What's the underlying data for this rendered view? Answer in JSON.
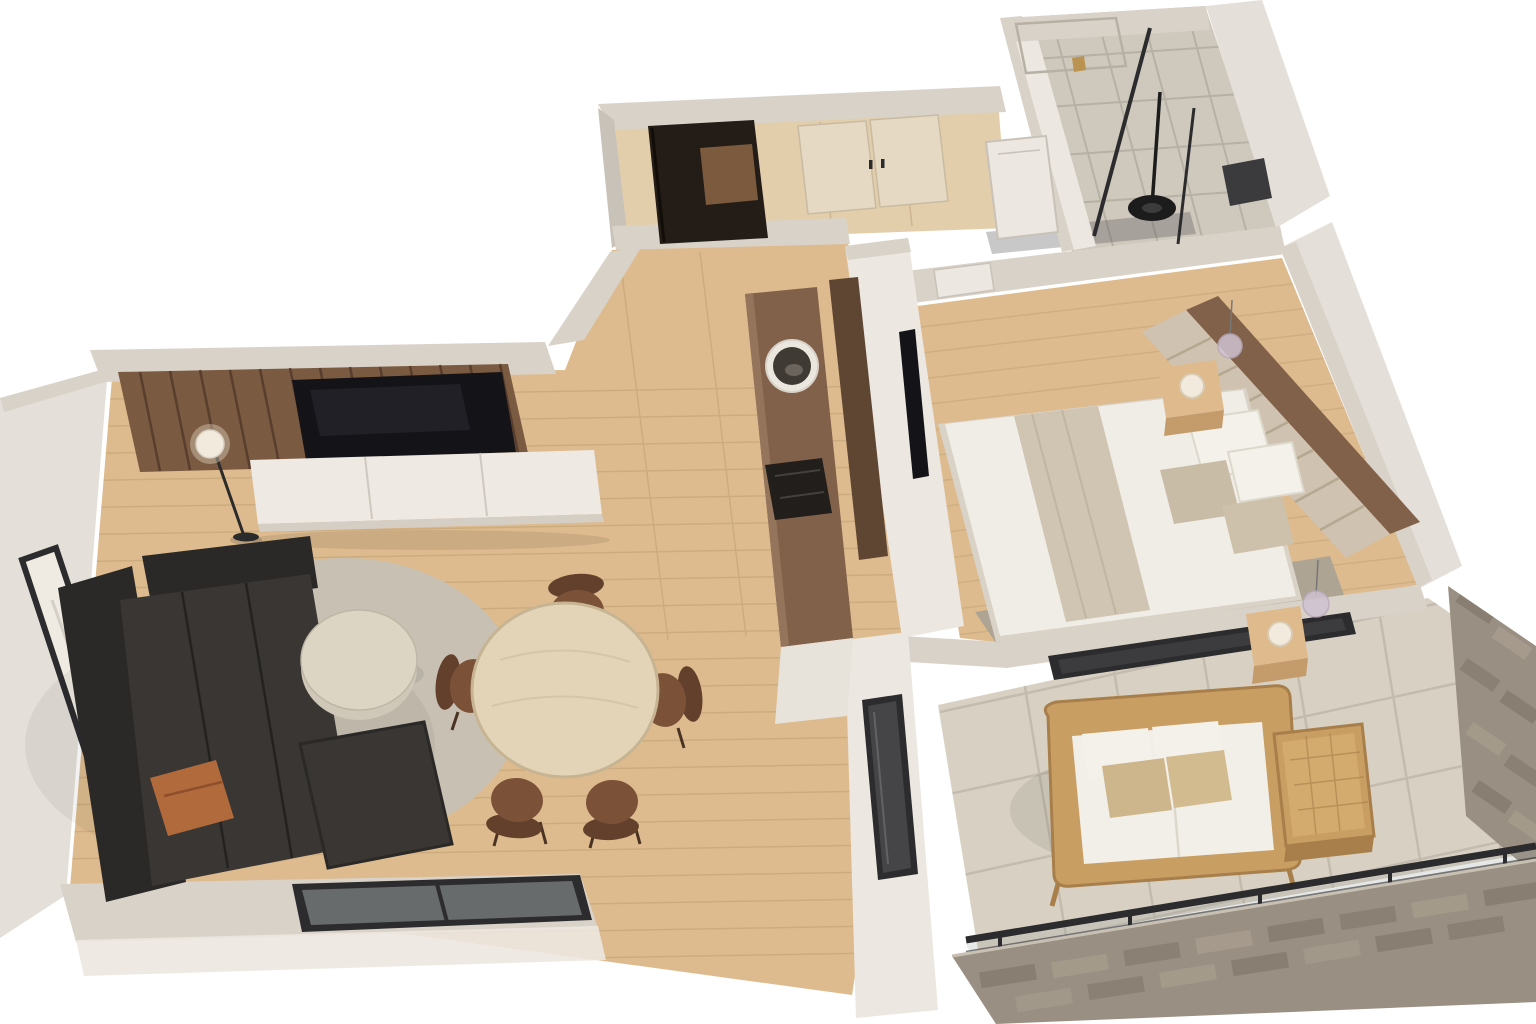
{
  "scene": {
    "title": "3D isometric cutaway floor plan of a one-bedroom apartment",
    "style": "photorealistic dollhouse render on white background"
  },
  "palette": {
    "bg": "#ffffff",
    "wallTop": "#d9d2c8",
    "wallFace": "#ece7e0",
    "wallShade": "#c9c2b8",
    "wallOuter": "#e4dfd8",
    "woodFloor": "#ddbb8e",
    "woodLine": "#c9a97c",
    "woodHall": "#e2ceab",
    "walnut": "#82614a",
    "walnutDark": "#5f4633",
    "slat": "#7a5a40",
    "slatLine": "#54392a",
    "tvBlack": "#141418",
    "frameBlack": "#2c2c2e",
    "doorDark": "#241c16",
    "console": "#eee9e2",
    "consoleShade": "#d5cec5",
    "sofa": "#393633",
    "sofaDark": "#2b2927",
    "pillowRust": "#b16a3c",
    "rug": "#c8c0b3",
    "coffeeTable": "#ddd5c4",
    "diningTable": "#e3d4b8",
    "diningRim": "#c6b492",
    "chair": "#7b5138",
    "chairDark": "#63402c",
    "sheet": "#f0ede7",
    "blanket": "#cfc5b2",
    "pillowTaupe": "#c9bca6",
    "headboard": "#cfc2b0",
    "headboardLine": "#b5a890",
    "nightstand": "#dfba8c",
    "nightstandSide": "#c49b6b",
    "lampWhite": "#f1eadd",
    "pendant": "#cfc2d2",
    "carpet": "#a9a295",
    "tileBath": "#cfc8bc",
    "tileGrout": "#b7b0a4",
    "balconyTile": "#d8d1c3",
    "balconyGrout": "#c3bcae",
    "wicker": "#c99e63",
    "wickerDark": "#a87f4a",
    "cushionWhite": "#f2efe8",
    "cushionTan": "#cdb68c",
    "stone": "#998f83",
    "stoneDark": "#6f6659",
    "stoneLight": "#b3a997",
    "glassDark": "#4a4a4c",
    "glassTint": "#9aa0a0",
    "gold": "#b9934f"
  },
  "rooms": {
    "living": {
      "label": "Living room"
    },
    "dining": {
      "label": "Dining area"
    },
    "kitchen": {
      "label": "Kitchenette"
    },
    "hallway": {
      "label": "Hallway"
    },
    "entry": {
      "label": "Entry"
    },
    "bathroom": {
      "label": "Bathroom"
    },
    "bedroom": {
      "label": "Bedroom"
    },
    "balcony": {
      "label": "Balcony"
    }
  },
  "furniture": {
    "slatWall": {
      "label": "Walnut slat TV feature wall"
    },
    "tv": {
      "label": "Wall-mounted TV"
    },
    "console": {
      "label": "Floating media console"
    },
    "floorLamp": {
      "label": "Globe floor lamp"
    },
    "artwork": {
      "label": "Leaning framed artwork"
    },
    "sofa": {
      "label": "Charcoal sectional sofa with chaise"
    },
    "rustPillow": {
      "label": "Rust accent pillow"
    },
    "coffeeTable": {
      "label": "Round cream coffee table"
    },
    "rug": {
      "label": "Round area rug"
    },
    "diningTable": {
      "label": "Round oak dining table"
    },
    "diningChairs": {
      "label": "Brown upholstered dining chairs"
    },
    "counter": {
      "label": "Walnut kitchenette counter"
    },
    "sink": {
      "label": "Round vessel basin"
    },
    "cooktop": {
      "label": "Built-in cooktop"
    },
    "tallCabinet": {
      "label": "Tall walnut cabinet"
    },
    "wardrobe": {
      "label": "Hallway wardrobe with cream doors"
    },
    "hallDoor": {
      "label": "White interior door"
    },
    "entryCabinet": {
      "label": "Entry cabinet"
    },
    "bed": {
      "label": "Double bed with greige throw"
    },
    "headboard": {
      "label": "Channel-tufted headboard on walnut panel"
    },
    "nightstand1": {
      "label": "Oak nightstand with dome lamp"
    },
    "nightstand2": {
      "label": "Oak nightstand with dome lamp"
    },
    "pendant1": {
      "label": "Glass globe pendant"
    },
    "pendant2": {
      "label": "Glass globe pendant"
    },
    "bedroomTv": {
      "label": "Bedroom TV on partition wall"
    },
    "bedCarpet": {
      "label": "Bedroom carpet runner"
    },
    "shower": {
      "label": "Walk-in shower with black glass"
    },
    "showerFixture": {
      "label": "Black shower column"
    },
    "faucet": {
      "label": "Brass tap"
    },
    "bathWindow": {
      "label": "Bathroom vent window"
    },
    "slidingDoor": {
      "label": "Sliding glass door"
    },
    "balconyDoor": {
      "label": "Balcony door from living area"
    },
    "bedroomWindow": {
      "label": "Bedroom picture window to balcony"
    },
    "loveseat": {
      "label": "Rattan loveseat with white cushions"
    },
    "sideTable": {
      "label": "Rattan side table"
    },
    "railing": {
      "label": "Black-framed glass railing"
    },
    "stoneWallRight": {
      "label": "Stone feature wall"
    },
    "stoneWallBottom": {
      "label": "Exterior stone cladding"
    }
  }
}
